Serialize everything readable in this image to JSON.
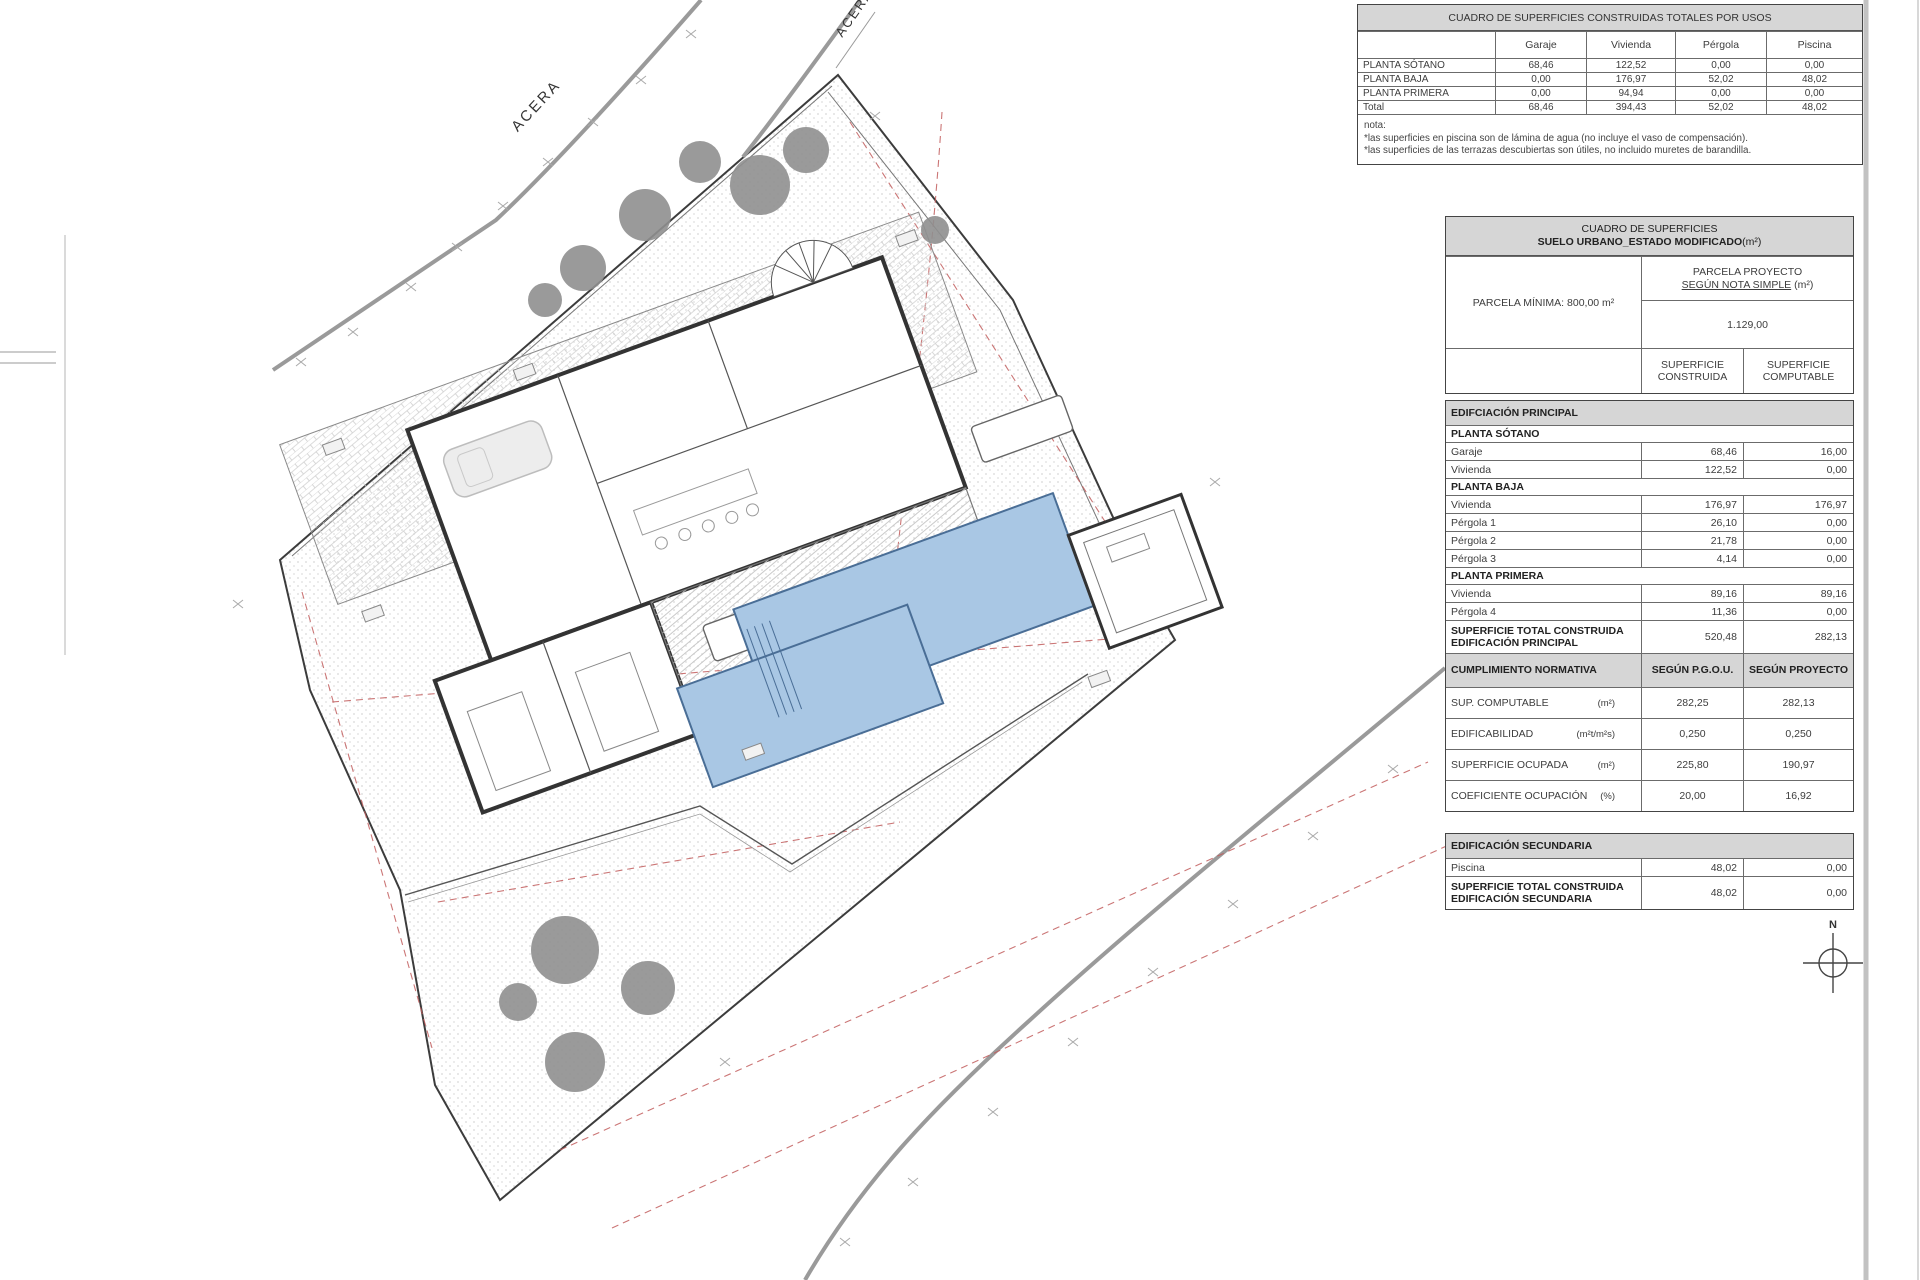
{
  "plan": {
    "acera_label_top": "ACERA",
    "acera_label_right": "ACERA",
    "north_label": "N",
    "colors": {
      "pool_fill": "#a9c7e4",
      "pool_stroke": "#4a6e96",
      "setback_dashed": "#c25e5e",
      "hatch": "#d8d8d8",
      "walls": "#333333",
      "trees": "#8f8f8f"
    }
  },
  "table_usos": {
    "title": "CUADRO DE SUPERFICIES CONSTRUIDAS TOTALES POR USOS",
    "columns": [
      "Garaje",
      "Vivienda",
      "Pérgola",
      "Piscina"
    ],
    "rows": [
      {
        "label": "PLANTA SÓTANO",
        "v1": "68,46",
        "v2": "122,52",
        "v3": "0,00",
        "v4": "0,00"
      },
      {
        "label": "PLANTA BAJA",
        "v1": "0,00",
        "v2": "176,97",
        "v3": "52,02",
        "v4": "48,02"
      },
      {
        "label": "PLANTA PRIMERA",
        "v1": "0,00",
        "v2": "94,94",
        "v3": "0,00",
        "v4": "0,00"
      },
      {
        "label": "Total",
        "v1": "68,46",
        "v2": "394,43",
        "v3": "52,02",
        "v4": "48,02"
      }
    ],
    "note_title": "nota:",
    "note_line1": "*las superficies en piscina son de lámina de agua (no incluye el vaso de compensación).",
    "note_line2": "*las superficies de las terrazas descubiertas son útiles, no incluido muretes de barandilla."
  },
  "t2": {
    "title_line1": "CUADRO DE SUPERFICIES",
    "title_line2": "SUELO URBANO_ESTADO MODIFICADO",
    "title_suffix": "(m²)",
    "parcela_minima": "PARCELA MÍNIMA: 800,00 m²",
    "proyecto_l1": "PARCELA PROYECTO",
    "proyecto_l2_main": "SEGÚN NOTA SIMPLE",
    "proyecto_l2_suffix": " (m²)",
    "proyecto_value": "1.129,00",
    "col_construida": "SUPERFICIE CONSTRUIDA",
    "col_computable": "SUPERFICIE COMPUTABLE",
    "rows": [
      {
        "label": "EDIFCIACIÓN PRINCIPAL"
      },
      {
        "label": "PLANTA SÓTANO"
      },
      {
        "label": "Garaje",
        "c": "68,46",
        "k": "16,00"
      },
      {
        "label": "Vivienda",
        "c": "122,52",
        "k": "0,00"
      },
      {
        "label": "PLANTA BAJA"
      },
      {
        "label": "Vivienda",
        "c": "176,97",
        "k": "176,97"
      },
      {
        "label": "Pérgola 1",
        "c": "26,10",
        "k": "0,00"
      },
      {
        "label": "Pérgola 2",
        "c": "21,78",
        "k": "0,00"
      },
      {
        "label": "Pérgola 3",
        "c": "4,14",
        "k": "0,00"
      },
      {
        "label": "PLANTA PRIMERA"
      },
      {
        "label": "Vivienda",
        "c": "89,16",
        "k": "89,16"
      },
      {
        "label": "Pérgola 4",
        "c": "11,36",
        "k": "0,00"
      },
      {
        "l1": "SUPERFICIE TOTAL CONSTRUIDA",
        "l2": "EDIFICACIÓN PRINCIPAL",
        "c": "520,48",
        "k": "282,13"
      },
      {
        "label": "CUMPLIMIENTO NORMATIVA",
        "c": "SEGÚN P.G.O.U.",
        "k": "SEGÚN PROYECTO"
      },
      {
        "label": "SUP. COMPUTABLE",
        "unit": "(m²)",
        "c": "282,25",
        "k": "282,13"
      },
      {
        "label": "EDIFICABILIDAD",
        "unit": "(m²t/m²s)",
        "c": "0,250",
        "k": "0,250"
      },
      {
        "label": "SUPERFICIE OCUPADA",
        "unit": "(m²)",
        "c": "225,80",
        "k": "190,97"
      },
      {
        "label": "COEFICIENTE OCUPACIÓN",
        "unit": "(%)",
        "c": "20,00",
        "k": "16,92"
      },
      {
        "label": "EDIFICACIÓN SECUNDARIA"
      },
      {
        "label": "Piscina",
        "c": "48,02",
        "k": "0,00"
      },
      {
        "l1": "SUPERFICIE TOTAL CONSTRUIDA",
        "l2": "EDIFICACIÓN SECUNDARIA",
        "c": "48,02",
        "k": "0,00"
      }
    ]
  }
}
